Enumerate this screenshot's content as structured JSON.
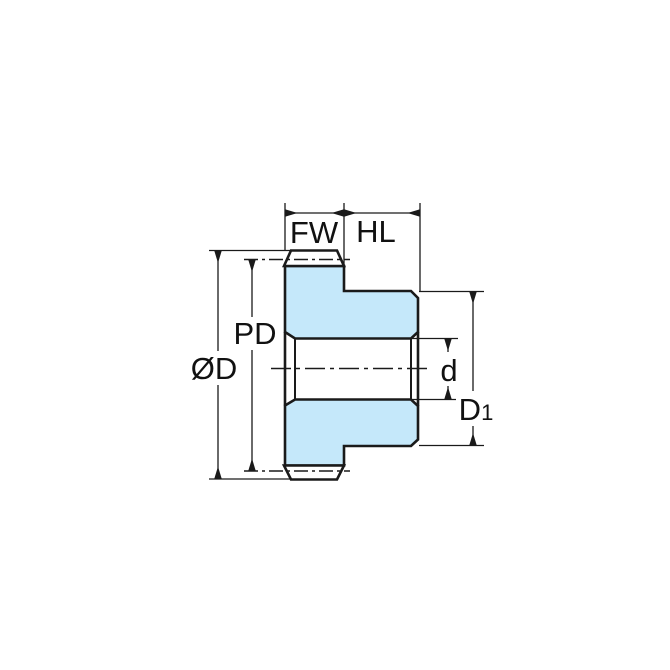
{
  "diagram": {
    "name": "Spur gear cross-section dimension drawing",
    "type": "technical-drawing",
    "colors": {
      "part_fill": "#C5E8FA",
      "line": "#1a1a1a",
      "background": "#ffffff"
    },
    "labels": {
      "face_width": "FW",
      "hub_length": "HL",
      "outside_diameter": "ØD",
      "pitch_diameter": "PD",
      "bore_diameter": "d",
      "hub_diameter_main": "D",
      "hub_diameter_sub": "1"
    }
  }
}
